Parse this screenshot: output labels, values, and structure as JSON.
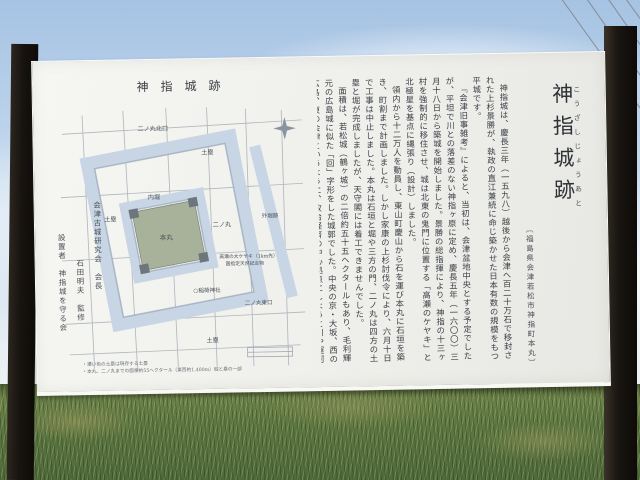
{
  "sign": {
    "title": "神指城跡",
    "title_furigana": "こうざしじょうあと",
    "title_note": "〔福島県会津若松市神指町本丸〕",
    "body_paragraphs": [
      "神指城は、慶長三年（一五九八）越後から会津へ百二十万石で移封された上杉景勝が、執政の直江兼続に命じ築かせた日本有数の規模をもつ平城です。",
      "『会津旧事雑考』によると、当初は、会津盆地中央とする予定でしたが、平坦で川との落差のない神指ヶ原に定め、慶長五年（一六〇〇）三月十八日から築城を開始しました。景勝の総指揮により、神指の十三ヶ村を強制的に移住させ、城は北東の鬼門に位置する「高瀬のケヤキ」と北極星を基点に縄張り（設計）しました。",
      "領内から十二万人を動員し、東山町慶山から石を運び本丸に石垣を築き、町割まで計画しました。しかし家康の上杉討伐令により、六月十日で工事は中止しました。本丸は石垣と堀や三方の門、二ノ丸は四方の土塁と堀が完成しましたが、天守閣には着工できませんでした。",
      "面積は、若松城（鶴ヶ城）の二倍約五十五ヘクタールもあり、毛利輝元の広島城に似た「回」字形をした城郭でした。中央の京・大坂、西の広島、東の会津というように、政治経済の中心拠点にしようと川や運河を利用して築こうとしました。慶長六年（一六〇一）に上杉氏は、米沢三十万石へ移封となり、城は破城され、更に寛永十六年（一六三九）領主加藤氏が、石垣を崩して若松城（鶴ヶ城）に運び去り、神指城は廃城となりました。"
    ],
    "map": {
      "title": "神指城跡",
      "labels": {
        "ninomaru_north_gate": "二ノ丸北口",
        "dorui": "土塁",
        "uchibori": "内堀",
        "honmaru": "本丸",
        "ninomaru": "二ノ丸",
        "sotobori": "外堀跡",
        "inari_shrine": "○稲荷神社",
        "ninomaru_east_gate": "二ノ丸東口",
        "keyaki_note_1": "高瀬の大ケヤキ（1km先）",
        "keyaki_note_2": "国指定天然記念物"
      },
      "notes": [
        "・濃い色の土塁は現存する土塁",
        "・本丸、二ノ丸までの面積約55ヘクタール（東西約1,400m）堀と塁の一部"
      ],
      "credits": [
        "会津古城研究会　会長",
        "石田明夫　監修",
        "設置者　神指城を守る会"
      ]
    }
  }
}
